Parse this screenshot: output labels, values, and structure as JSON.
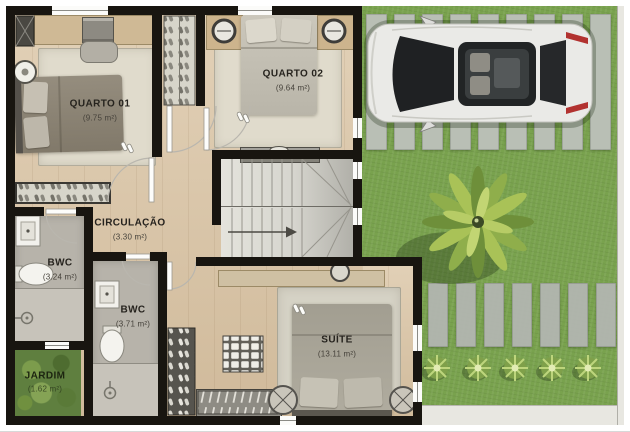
{
  "rooms": {
    "quarto01": {
      "label": "QUARTO 01",
      "area": "(9.75 m²)"
    },
    "quarto02": {
      "label": "QUARTO 02",
      "area": "(9.64 m²)"
    },
    "circulacao": {
      "label": "CIRCULAÇÃO",
      "area": "(3.30 m²)"
    },
    "bwc1": {
      "label": "BWC",
      "area": "(3.24 m²)"
    },
    "bwc2": {
      "label": "BWC",
      "area": "(3.71 m²)"
    },
    "suite": {
      "label": "SUÍTE",
      "area": "(13.11 m²)"
    },
    "jardim": {
      "label": "JARDIM",
      "area": "(1.62 m²)"
    }
  },
  "outdoor": {
    "elements": [
      "car-top-view",
      "driveway-paver-strips",
      "palm-tree",
      "lawn",
      "shrub-row",
      "sidewalk",
      "fence"
    ]
  },
  "indoor_elements": [
    "double-bed",
    "desk",
    "office-chair",
    "wardrobe",
    "shoe-rack",
    "closet",
    "stairs",
    "toilet",
    "sink",
    "shower-drain",
    "nightstand-lamp",
    "rug",
    "door-swing"
  ],
  "colors": {
    "wall": "#181510",
    "wood_floor": "#dcc7a8",
    "tile_floor": "#b7b3aa",
    "grass": "#79a24e",
    "paver": "#bdc1bb",
    "rug": "#e0dbcc",
    "label_text": "#26231e",
    "car_body": "#eaeae7",
    "taillight_red": "#b23230"
  }
}
